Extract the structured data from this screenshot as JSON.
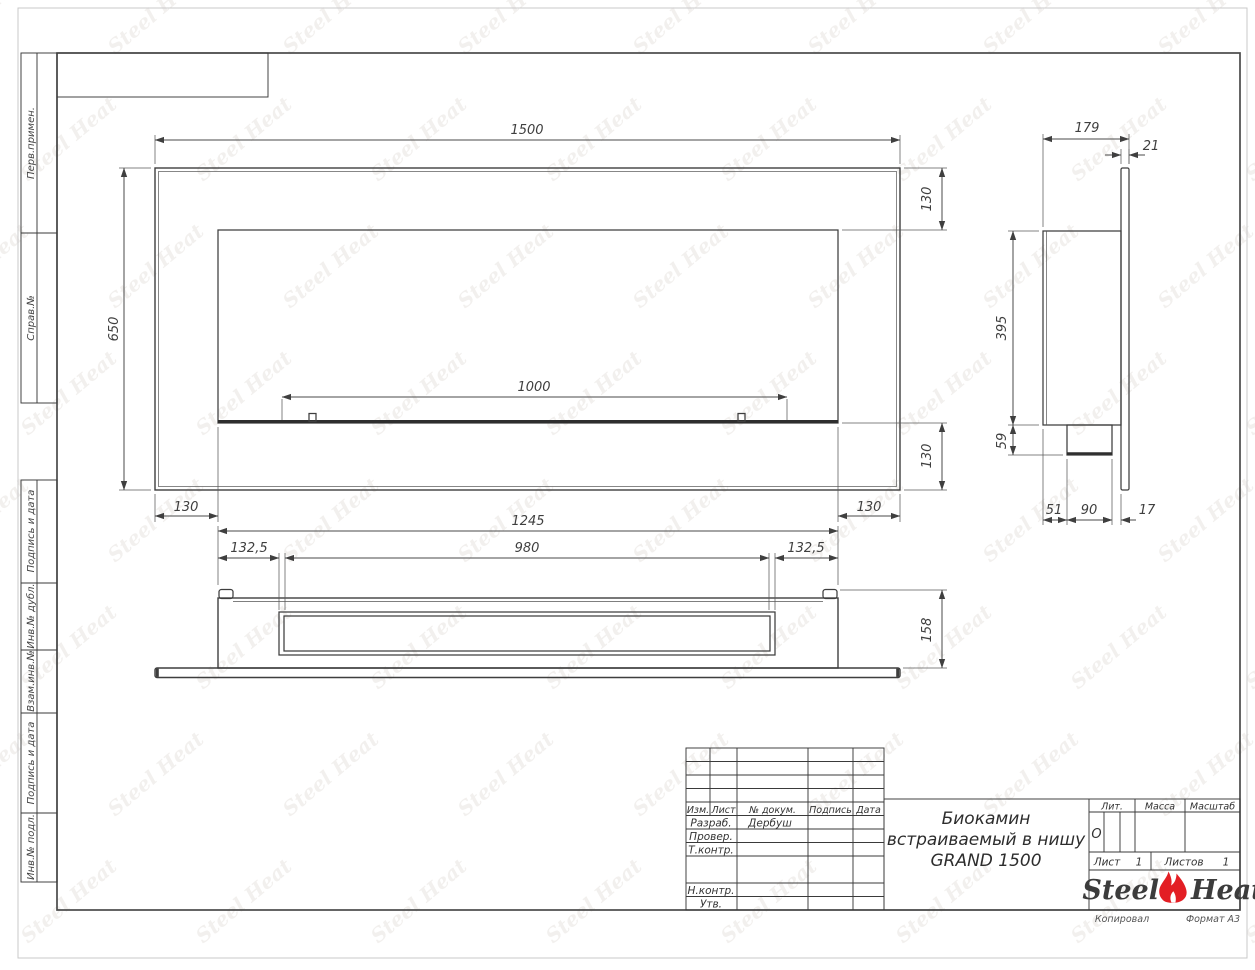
{
  "watermark": {
    "text": "Steel Heat"
  },
  "sheet": {
    "sidebar": {
      "items": [
        {
          "label": "Перв.примен."
        },
        {
          "label": "Справ.№"
        },
        {
          "label": "Подпись и дата"
        },
        {
          "label": "Инв.№ дубл."
        },
        {
          "label": "Взам.инв.№"
        },
        {
          "label": "Подпись и дата"
        },
        {
          "label": "Инв.№ подл."
        }
      ]
    },
    "footer": {
      "copied": "Копировал",
      "format": "Формат А3"
    }
  },
  "views": {
    "front": {
      "width": "1500",
      "height": "650",
      "offset_top": "130",
      "offset_bottom": "130",
      "offset_left": "130",
      "offset_right": "130",
      "burner_width": "1000"
    },
    "side": {
      "depth": "179",
      "panel": "21",
      "body_height": "395",
      "burner_height": "59",
      "back": "51",
      "burner_depth": "90",
      "gap": "17"
    },
    "bottom": {
      "overall": "1245",
      "margin_left": "132,5",
      "opening": "980",
      "margin_right": "132,5",
      "depth": "158"
    }
  },
  "title_block": {
    "revision_header": {
      "izm": "Изм.",
      "list": "Лист",
      "doc": "№ докум.",
      "sign": "Подпись",
      "date": "Дата"
    },
    "roles": [
      {
        "label": "Разраб.",
        "value": "Дербуш"
      },
      {
        "label": "Провер.",
        "value": ""
      },
      {
        "label": "Т.контр.",
        "value": ""
      },
      {
        "label": "Н.контр.",
        "value": ""
      },
      {
        "label": "Утв.",
        "value": ""
      }
    ],
    "doc_title_line1": "Биокамин",
    "doc_title_line2": "встраиваемый в нишу",
    "doc_title_line3": "GRAND 1500",
    "lit": {
      "label": "Лит.",
      "value": "О"
    },
    "mass": {
      "label": "Масса",
      "value": ""
    },
    "scale": {
      "label": "Масштаб",
      "value": ""
    },
    "sheet_no": {
      "label": "Лист",
      "value": "1"
    },
    "sheets": {
      "label": "Листов",
      "value": "1"
    },
    "logo": {
      "word1": "Steel",
      "word2": "Heat",
      "flame_color": "#e31e24"
    }
  }
}
